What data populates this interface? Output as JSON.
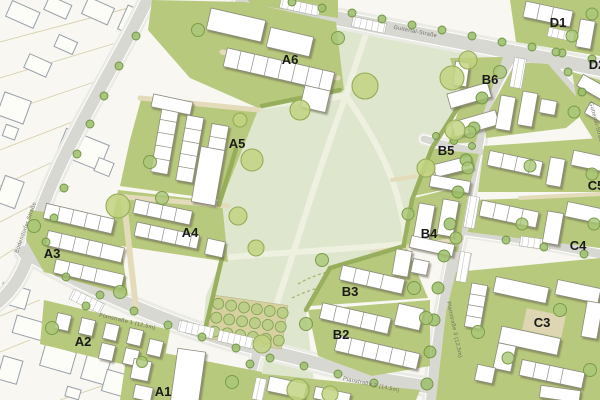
{
  "map": {
    "kind": "site-development-plan",
    "zones": [
      {
        "label": "A1"
      },
      {
        "label": "A2"
      },
      {
        "label": "A3"
      },
      {
        "label": "A4"
      },
      {
        "label": "A5"
      },
      {
        "label": "A6"
      },
      {
        "label": "B2"
      },
      {
        "label": "B3"
      },
      {
        "label": "B4"
      },
      {
        "label": "B5"
      },
      {
        "label": "B6"
      },
      {
        "label": "C3"
      },
      {
        "label": "C4"
      },
      {
        "label": "C5"
      },
      {
        "label": "D1"
      },
      {
        "label": "D2"
      }
    ],
    "streets": [
      {
        "name": "Guttertal-Straße"
      },
      {
        "name": "Bodendorfer Straße"
      },
      {
        "name": "Planstraße 1 (12,5m)"
      },
      {
        "name": "Planstraße 2 (14,5m)"
      },
      {
        "name": "Planstraße 3 (12,5m)"
      }
    ],
    "colors": {
      "park_green": "#dee7cd",
      "lawn_green": "#b7c97c",
      "tree_green": "#a9c775",
      "road_gray": "#d8d8d3",
      "building_white": "#ffffff",
      "orchard_tan": "#d7d1a0",
      "existing_bg": "#f8f7f2"
    }
  }
}
